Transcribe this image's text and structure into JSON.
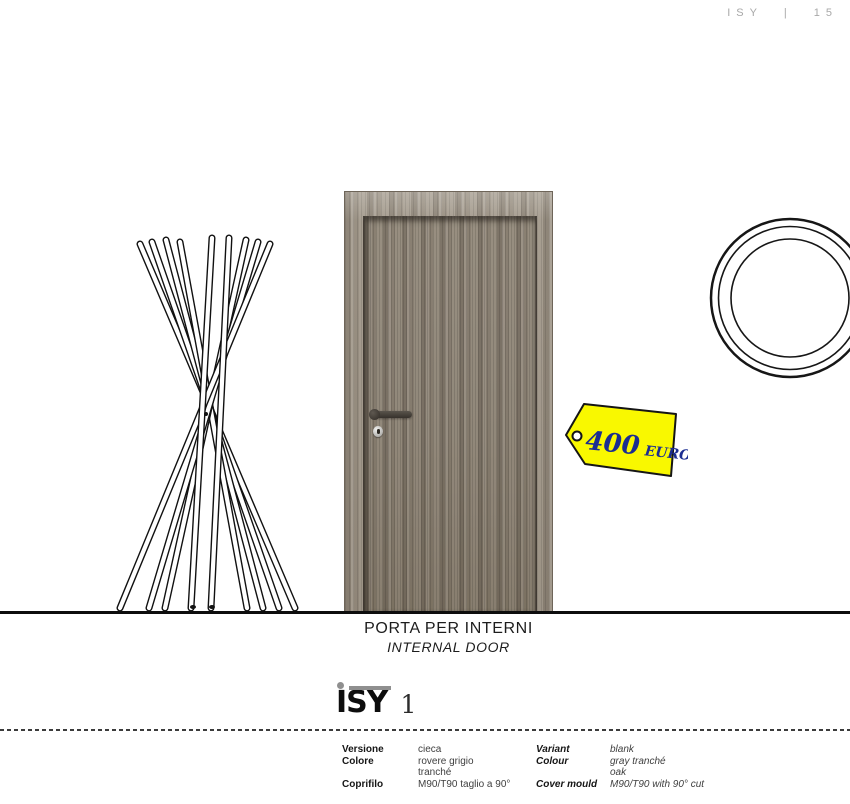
{
  "header": {
    "page_marker": "ISY | 15"
  },
  "scene": {
    "drawings": {
      "coat_rack_icon": "coat-rack-line-drawing",
      "mirror_icon": "round-mirror-line-drawing"
    },
    "price": {
      "amount": "400",
      "currency": "EURO"
    },
    "caption_it": "PORTA PER INTERNI",
    "caption_en": "INTERNAL DOOR"
  },
  "title": {
    "brand": "ISY",
    "number": "1"
  },
  "specs": {
    "rows": [
      {
        "label_it": "Versione",
        "value_it": "cieca",
        "label_en": "Variant",
        "value_en": "blank"
      },
      {
        "label_it": "Colore",
        "value_it": "rovere grigio\ntranché",
        "label_en": "Colour",
        "value_en": "gray tranché\noak"
      },
      {
        "label_it": "Coprifilo",
        "value_it": "M90/T90 taglio a 90°",
        "label_en": "Cover mould",
        "value_en": "M90/T90 with 90° cut"
      }
    ]
  },
  "colors": {
    "tag_yellow": "#f9f800",
    "price_blue": "#1b2d91",
    "door_wood": "#8d8375",
    "floor_line": "#0d0d0d",
    "logo_gray": "#8f8f8f"
  }
}
